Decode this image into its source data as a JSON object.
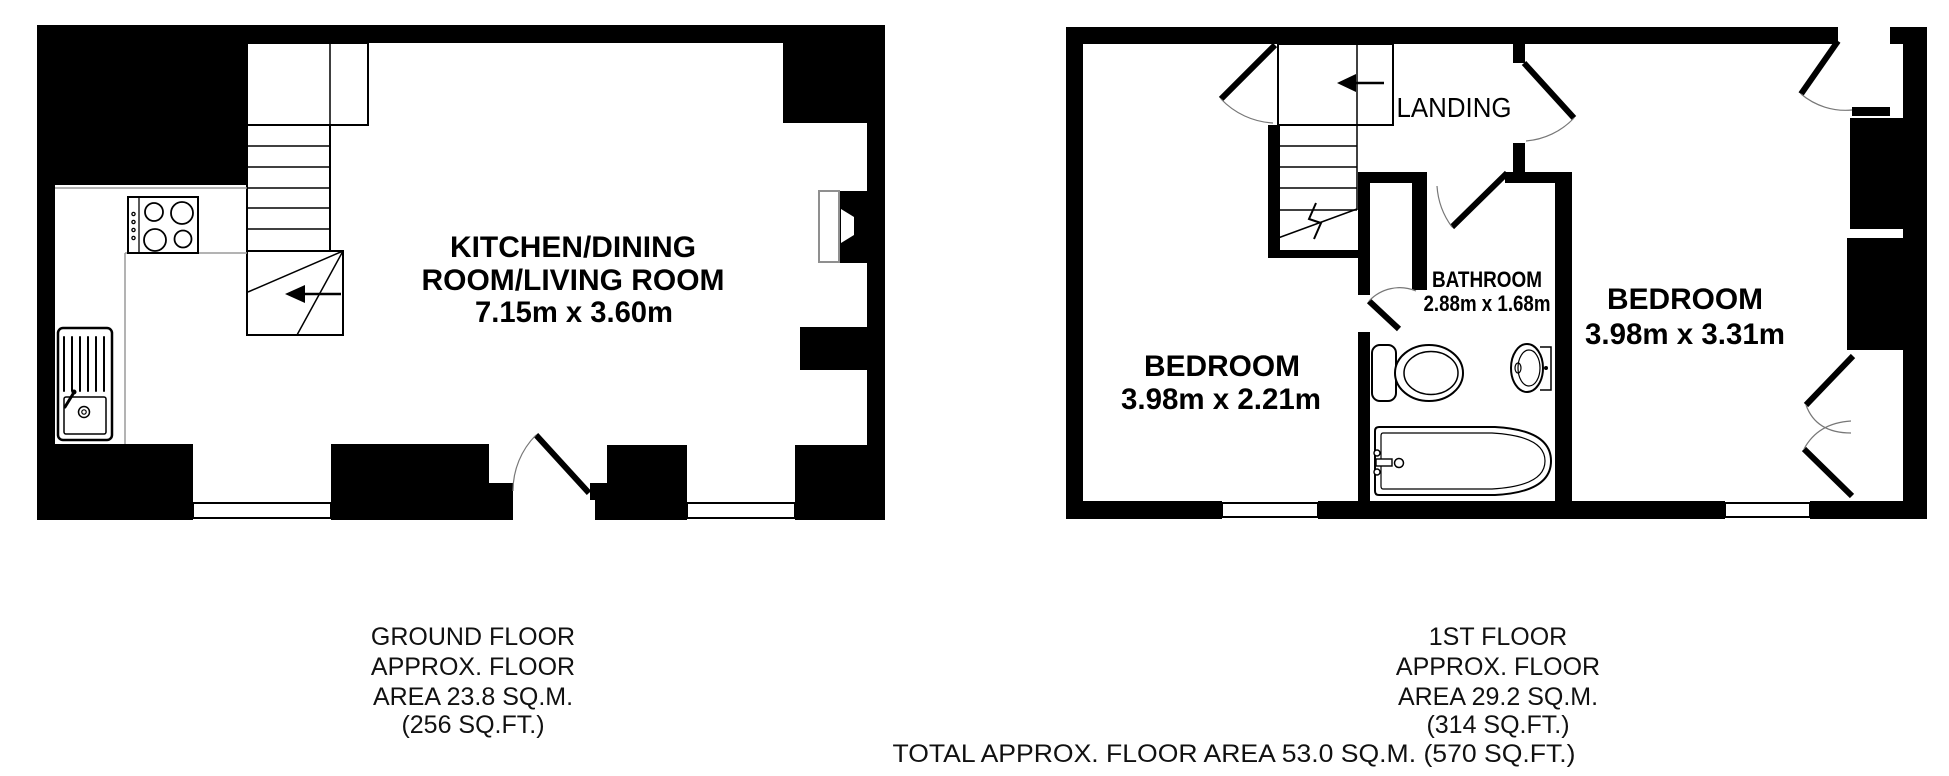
{
  "colors": {
    "background": "#ffffff",
    "wall": "#000000",
    "counter_line": "#9a9a9a",
    "window_frame_line": "#8f8f8f"
  },
  "ground_floor": {
    "room_label_line1": "KITCHEN/DINING",
    "room_label_line2": "ROOM/LIVING ROOM",
    "room_dimensions": "7.15m x 3.60m",
    "caption": [
      "GROUND FLOOR",
      "APPROX. FLOOR",
      "AREA 23.8 SQ.M.",
      "(256 SQ.FT.)"
    ]
  },
  "first_floor": {
    "landing_label": "LANDING",
    "bathroom_label": "BATHROOM",
    "bathroom_dimensions": "2.88m x 1.68m",
    "bedroom_left_label": "BEDROOM",
    "bedroom_left_dimensions": "3.98m x 2.21m",
    "bedroom_right_label": "BEDROOM",
    "bedroom_right_dimensions": "3.98m x 3.31m",
    "caption": [
      "1ST FLOOR",
      "APPROX. FLOOR",
      "AREA 29.2 SQ.M.",
      "(314 SQ.FT.)"
    ]
  },
  "totals": {
    "total_area": "TOTAL APPROX. FLOOR AREA 53.0 SQ.M. (570 SQ.FT.)"
  },
  "fixtures": [
    "staircase",
    "hob",
    "kitchen-sink",
    "toilet",
    "wash-basin",
    "bathtub"
  ]
}
